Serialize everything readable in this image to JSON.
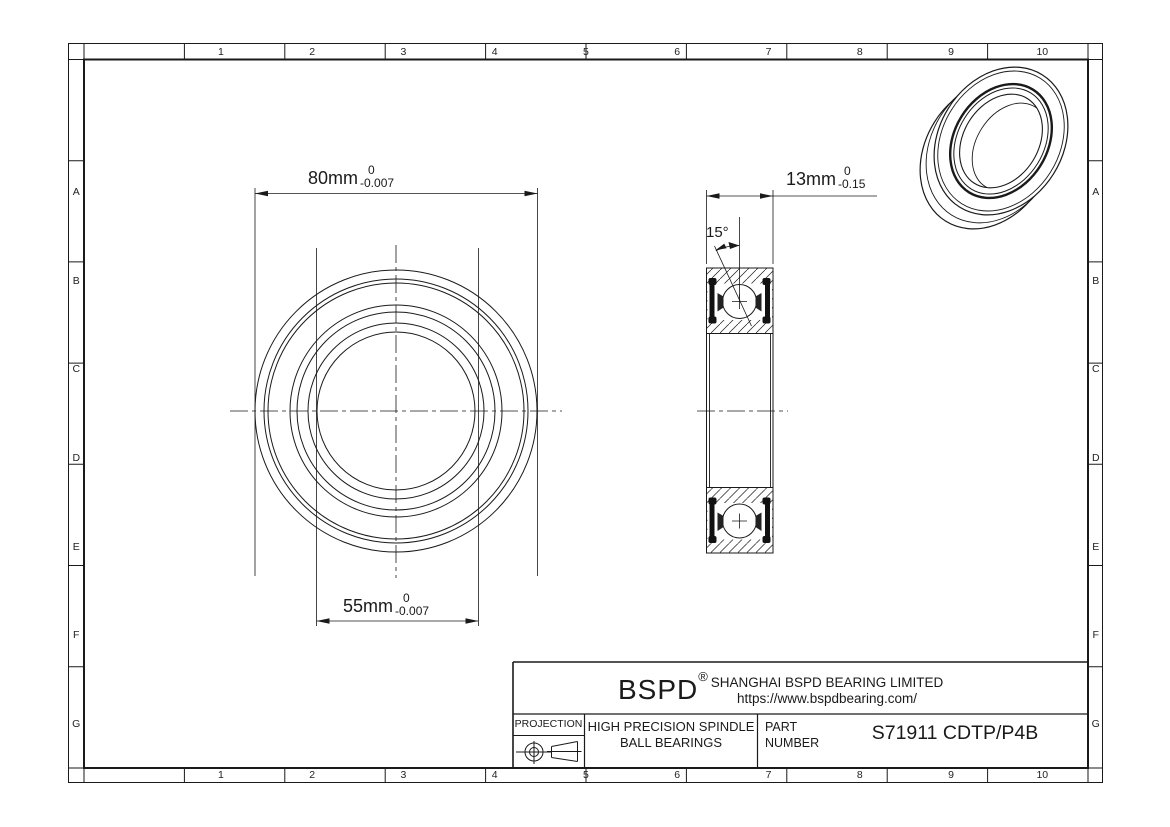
{
  "frame": {
    "columns": [
      "1",
      "2",
      "3",
      "4",
      "5",
      "6",
      "7",
      "8",
      "9",
      "10"
    ],
    "rows": [
      "A",
      "B",
      "C",
      "D",
      "E",
      "F",
      "G"
    ]
  },
  "dimensions": {
    "outer_diameter": {
      "value": "80mm",
      "tol_top": "0",
      "tol_bottom": "-0.007"
    },
    "bore_diameter": {
      "value": "55mm",
      "tol_top": "0",
      "tol_bottom": "-0.007"
    },
    "width": {
      "value": "13mm",
      "tol_top": "0",
      "tol_bottom": "-0.15"
    },
    "contact_angle": "15°"
  },
  "title_block": {
    "logo": "BSPD",
    "registered_mark": "®",
    "company": "SHANGHAI BSPD BEARING LIMITED",
    "website": "https://www.bspdbearing.com/",
    "projection_label": "PROJECTION",
    "product_line1": "HIGH  PRECISION SPINDLE",
    "product_line2": "BALL BEARINGS",
    "part_label_line1": "PART",
    "part_label_line2": "NUMBER",
    "part_number": "S71911 CDTP/P4B"
  },
  "colors": {
    "line": "#1a1a1a",
    "background": "#ffffff"
  }
}
